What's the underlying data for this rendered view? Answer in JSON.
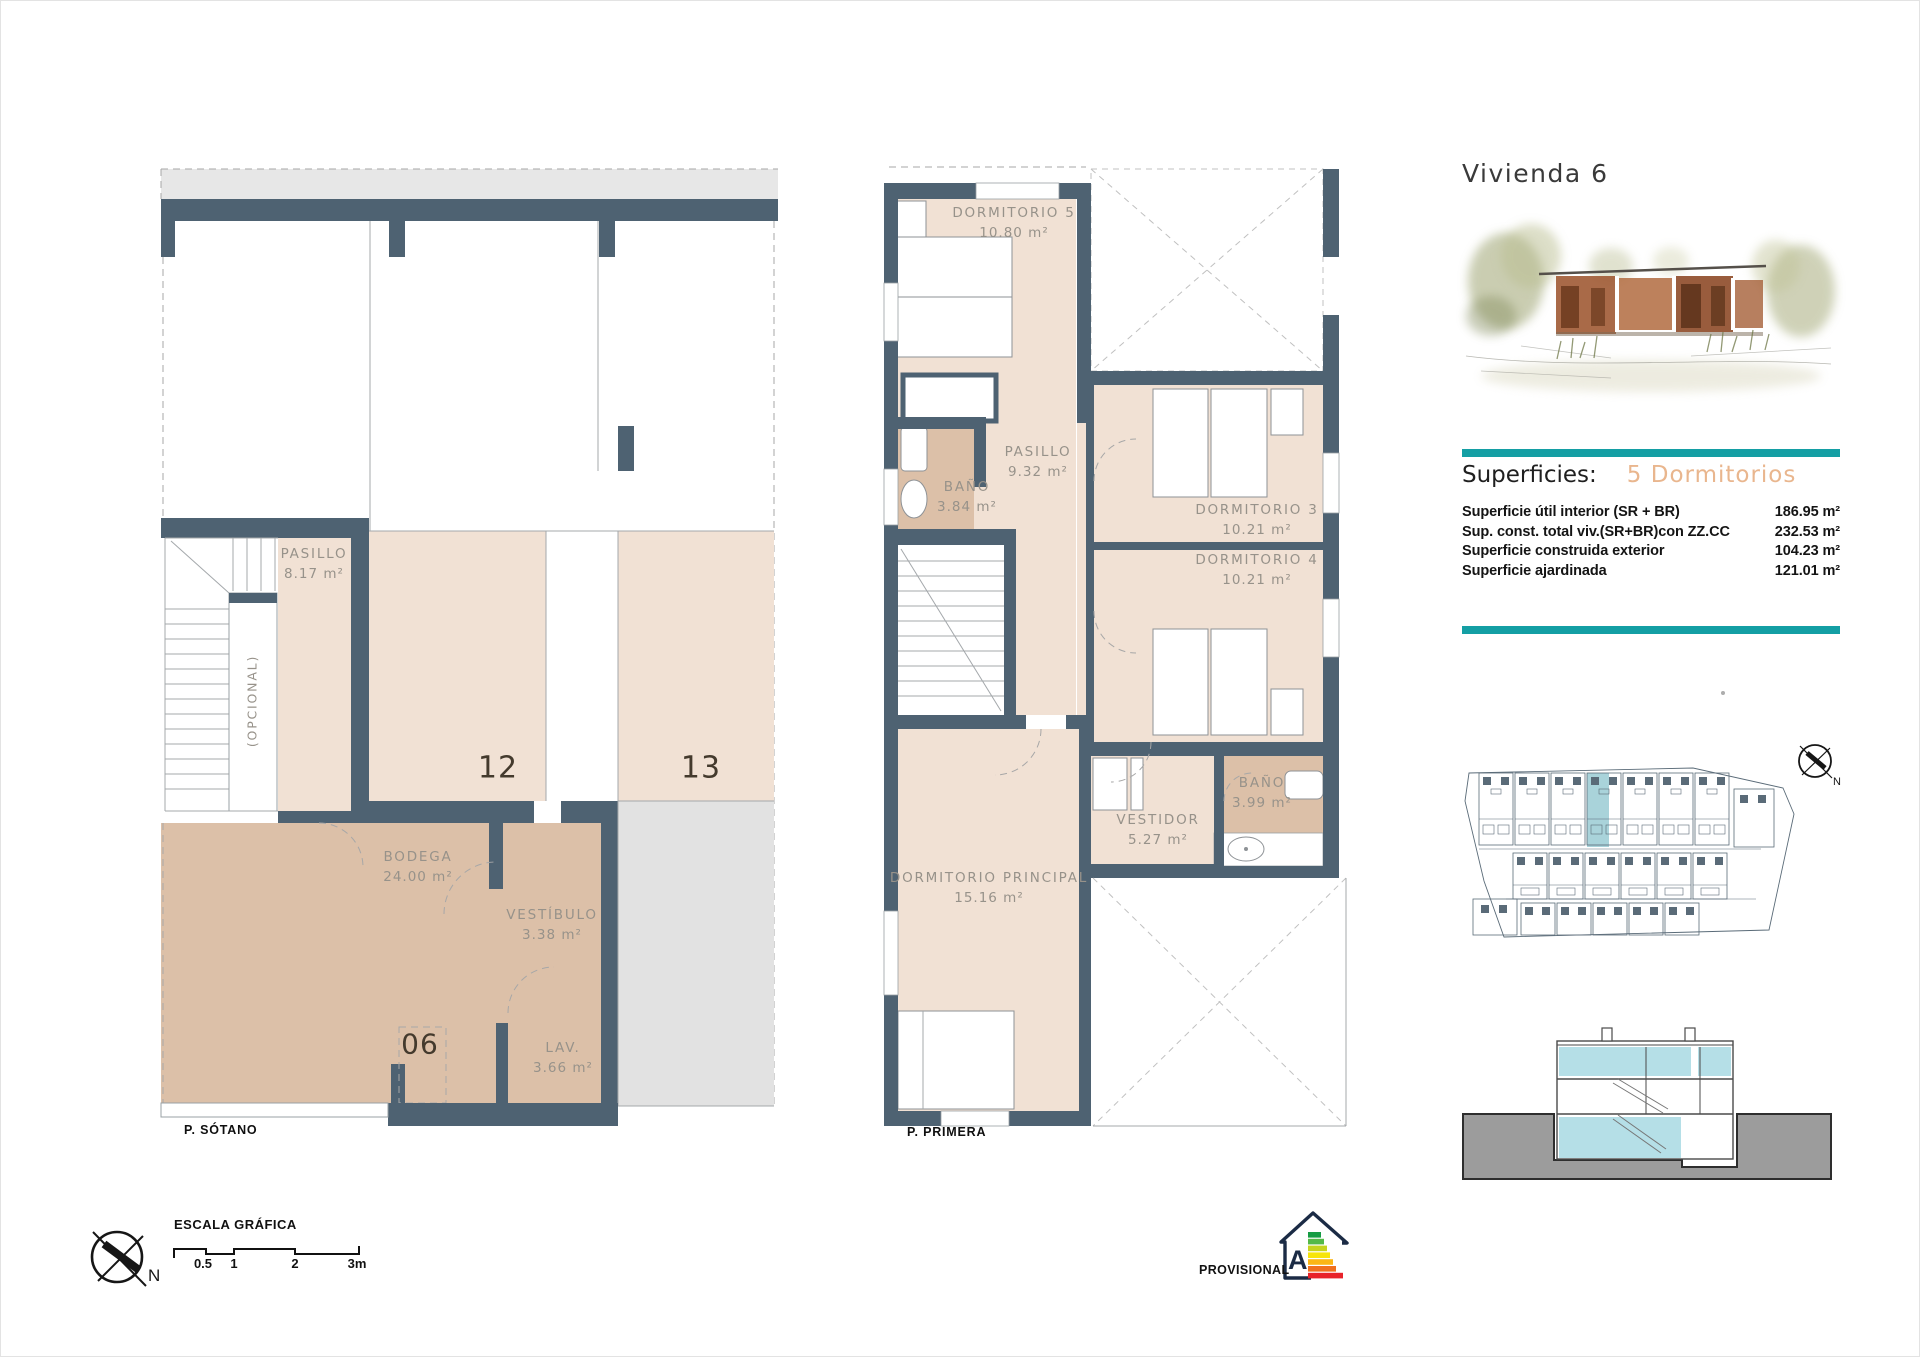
{
  "sheet": {
    "title": "Vivienda 6"
  },
  "superficies": {
    "heading": "Superficies:",
    "subtitle": "5 Dormitorios",
    "rows": [
      {
        "label": "Superficie útil interior (SR + BR)",
        "value": "186.95 m²"
      },
      {
        "label": "Sup. const. total viv.(SR+BR)con ZZ.CC",
        "value": "232.53 m²"
      },
      {
        "label": "Superficie construida exterior",
        "value": "104.23 m²"
      },
      {
        "label": "Superficie ajardinada",
        "value": "121.01 m²"
      }
    ]
  },
  "plans": {
    "sotano": {
      "floor_label": "P. SÓTANO",
      "rooms": [
        {
          "name": "PASILLO",
          "area": "8.17 m²"
        },
        {
          "name": "BODEGA",
          "area": "24.00 m²"
        },
        {
          "name": "VESTÍBULO",
          "area": "3.38 m²"
        },
        {
          "name": "LAV.",
          "area": "3.66 m²"
        }
      ],
      "optional_label": "(OPCIONAL)",
      "bays": [
        {
          "number": "12"
        },
        {
          "number": "13"
        },
        {
          "number": "06"
        }
      ]
    },
    "primera": {
      "floor_label": "P. PRIMERA",
      "rooms": [
        {
          "name": "DORMITORIO 5",
          "area": "10.80 m²"
        },
        {
          "name": "BAÑO",
          "area": "3.84 m²"
        },
        {
          "name": "PASILLO",
          "area": "9.32 m²"
        },
        {
          "name": "DORMITORIO 3",
          "area": "10.21 m²"
        },
        {
          "name": "DORMITORIO 4",
          "area": "10.21 m²"
        },
        {
          "name": "BAÑO",
          "area": "3.99 m²"
        },
        {
          "name": "VESTIDOR",
          "area": "5.27 m²"
        },
        {
          "name": "DORMITORIO PRINCIPAL",
          "area": "15.16 m²"
        }
      ]
    }
  },
  "scale_bar": {
    "title": "ESCALA GRÁFICA",
    "ticks": [
      "0.5",
      "1",
      "2",
      "3m"
    ]
  },
  "compass": {
    "north_label": "N"
  },
  "footer": {
    "provisional": "PROVISIONAL"
  },
  "energy_label": {
    "letter": "A",
    "bar_colors": [
      "#169c44",
      "#54b948",
      "#c6d41f",
      "#f7e50b",
      "#fbb615",
      "#f0701e",
      "#e8232a"
    ]
  },
  "colors": {
    "wall": "#4e6272",
    "room_light": "#f1e1d4",
    "room_tan": "#dcc0a8",
    "accent_teal": "#149fa4",
    "accent_peach": "#e9b68e",
    "site_highlight": "#a9d3da",
    "section_blue": "#b5dfe7",
    "ground_gray": "#9c9c9c"
  }
}
